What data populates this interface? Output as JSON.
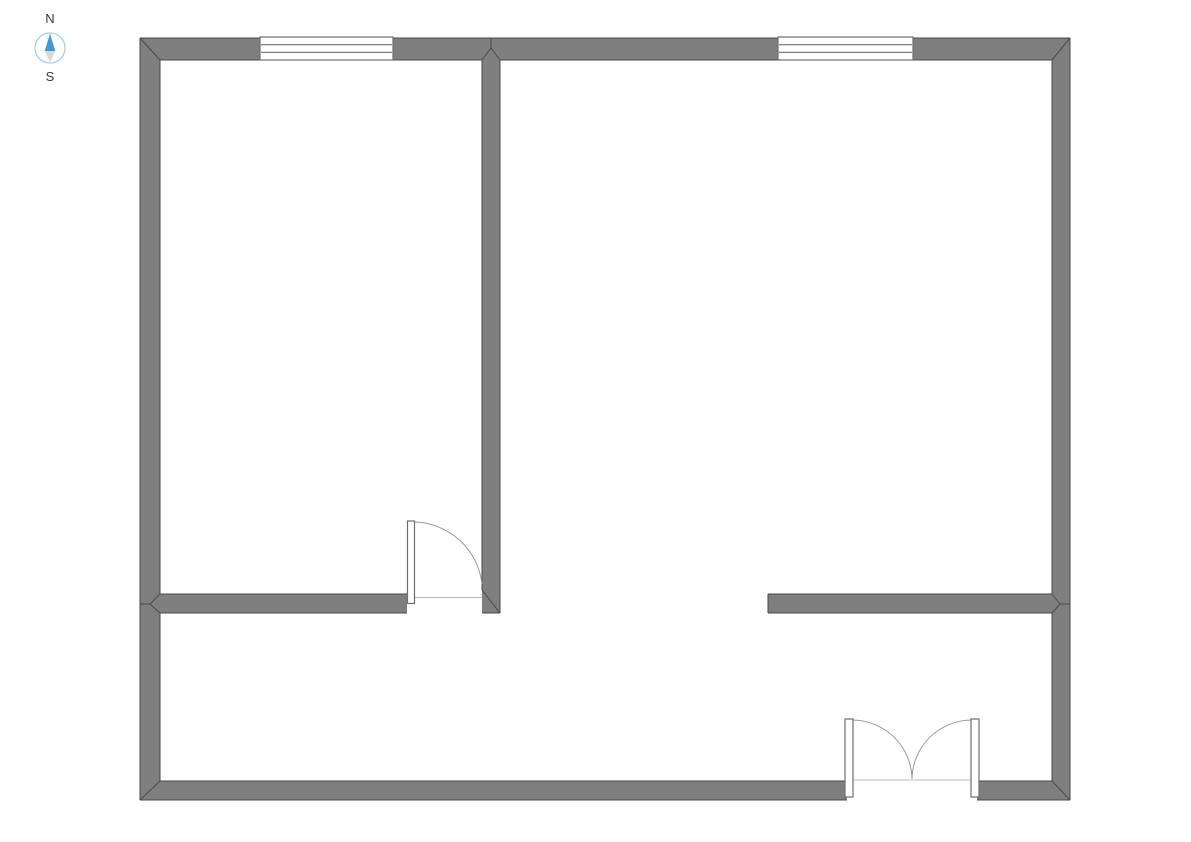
{
  "compass": {
    "north_label": "N",
    "south_label": "S"
  },
  "colors": {
    "background": "#FFFFFF",
    "wall_fill": "#7F7F7F",
    "wall_outline": "#4A4A4A",
    "opening_border": "#6E6E6E",
    "window_fill": "#FFFFFF",
    "swing_arc": "#999999",
    "threshold_line": "#BBBBBB",
    "compass_ring": "#A8CEE6",
    "compass_north": "#4697D3",
    "compass_south": "#D8D8D8",
    "compass_text": "#3A3A3A"
  },
  "floorplan": {
    "canvas": {
      "width": 1191,
      "height": 842
    },
    "walls": [
      {
        "id": "north",
        "x": 140,
        "y": 38,
        "w": 930,
        "h": 22
      },
      {
        "id": "west",
        "x": 140,
        "y": 38,
        "w": 20,
        "h": 762
      },
      {
        "id": "east",
        "x": 1052,
        "y": 38,
        "w": 18,
        "h": 762
      },
      {
        "id": "south-left",
        "x": 140,
        "y": 781,
        "w": 707,
        "h": 19
      },
      {
        "id": "south-right",
        "x": 977,
        "y": 781,
        "w": 93,
        "h": 19
      },
      {
        "id": "center-vertical",
        "x": 482,
        "y": 38,
        "w": 18,
        "h": 575
      },
      {
        "id": "middle-left",
        "x": 160,
        "y": 594,
        "w": 247,
        "h": 19
      },
      {
        "id": "middle-right",
        "x": 768,
        "y": 594,
        "w": 284,
        "h": 19
      }
    ],
    "outline_segments": [
      {
        "id": "outer-top",
        "x1": 140,
        "y1": 38,
        "x2": 1070,
        "y2": 38
      },
      {
        "id": "outer-left",
        "x1": 140,
        "y1": 38,
        "x2": 140,
        "y2": 800
      },
      {
        "id": "outer-right",
        "x1": 1070,
        "y1": 38,
        "x2": 1070,
        "y2": 800
      },
      {
        "id": "outer-bottom-a",
        "x1": 140,
        "y1": 800,
        "x2": 847,
        "y2": 800
      },
      {
        "id": "outer-bottom-b",
        "x1": 977,
        "y1": 800,
        "x2": 1070,
        "y2": 800
      },
      {
        "id": "north-inner-a",
        "x1": 160,
        "y1": 60,
        "x2": 260,
        "y2": 60
      },
      {
        "id": "north-inner-b",
        "x1": 393,
        "y1": 60,
        "x2": 482,
        "y2": 60
      },
      {
        "id": "north-inner-c",
        "x1": 500,
        "y1": 60,
        "x2": 778,
        "y2": 60
      },
      {
        "id": "north-inner-d",
        "x1": 913,
        "y1": 60,
        "x2": 1052,
        "y2": 60
      },
      {
        "id": "west-inner-a",
        "x1": 160,
        "y1": 60,
        "x2": 160,
        "y2": 594
      },
      {
        "id": "west-inner-b",
        "x1": 160,
        "y1": 613,
        "x2": 160,
        "y2": 781
      },
      {
        "id": "east-inner-a",
        "x1": 1052,
        "y1": 60,
        "x2": 1052,
        "y2": 594
      },
      {
        "id": "east-inner-b",
        "x1": 1052,
        "y1": 613,
        "x2": 1052,
        "y2": 781
      },
      {
        "id": "south-inner-a",
        "x1": 160,
        "y1": 781,
        "x2": 845,
        "y2": 781
      },
      {
        "id": "south-inner-b",
        "x1": 979,
        "y1": 781,
        "x2": 1052,
        "y2": 781
      },
      {
        "id": "center-left-face",
        "x1": 482,
        "y1": 60,
        "x2": 482,
        "y2": 590
      },
      {
        "id": "center-right-face",
        "x1": 500,
        "y1": 60,
        "x2": 500,
        "y2": 613
      },
      {
        "id": "center-bottom",
        "x1": 482,
        "y1": 613,
        "x2": 500,
        "y2": 613
      },
      {
        "id": "midleft-top",
        "x1": 160,
        "y1": 594,
        "x2": 407,
        "y2": 594
      },
      {
        "id": "midleft-bottom",
        "x1": 160,
        "y1": 613,
        "x2": 407,
        "y2": 613
      },
      {
        "id": "midright-top",
        "x1": 768,
        "y1": 594,
        "x2": 1052,
        "y2": 594
      },
      {
        "id": "midright-bottom",
        "x1": 768,
        "y1": 613,
        "x2": 1052,
        "y2": 613
      },
      {
        "id": "midright-endcap",
        "x1": 768,
        "y1": 594,
        "x2": 768,
        "y2": 613
      }
    ],
    "miter_segments": [
      {
        "id": "corner-top-left",
        "x1": 140,
        "y1": 38,
        "x2": 160,
        "y2": 60
      },
      {
        "id": "corner-top-right",
        "x1": 1070,
        "y1": 38,
        "x2": 1052,
        "y2": 60
      },
      {
        "id": "corner-bottom-left",
        "x1": 140,
        "y1": 800,
        "x2": 160,
        "y2": 781
      },
      {
        "id": "corner-bottom-right",
        "x1": 1070,
        "y1": 800,
        "x2": 1052,
        "y2": 781
      },
      {
        "id": "tee-top-a",
        "x1": 482,
        "y1": 60,
        "x2": 491,
        "y2": 48
      },
      {
        "id": "tee-top-b",
        "x1": 500,
        "y1": 60,
        "x2": 491,
        "y2": 48
      },
      {
        "id": "tee-top-c",
        "x1": 491,
        "y1": 48,
        "x2": 491,
        "y2": 38
      },
      {
        "id": "tee-west-a",
        "x1": 160,
        "y1": 594,
        "x2": 150,
        "y2": 604
      },
      {
        "id": "tee-west-b",
        "x1": 160,
        "y1": 613,
        "x2": 150,
        "y2": 604
      },
      {
        "id": "tee-west-c",
        "x1": 150,
        "y1": 604,
        "x2": 140,
        "y2": 604
      },
      {
        "id": "tee-east-a",
        "x1": 1052,
        "y1": 594,
        "x2": 1060,
        "y2": 604
      },
      {
        "id": "tee-east-b",
        "x1": 1052,
        "y1": 613,
        "x2": 1060,
        "y2": 604
      },
      {
        "id": "tee-east-c",
        "x1": 1060,
        "y1": 604,
        "x2": 1070,
        "y2": 604
      },
      {
        "id": "center-wall-end",
        "x1": 482,
        "y1": 590,
        "x2": 500,
        "y2": 613
      }
    ],
    "windows": [
      {
        "id": "north-left",
        "x": 260,
        "y": 37,
        "w": 133,
        "h": 23,
        "panes": 3
      },
      {
        "id": "north-right",
        "x": 778,
        "y": 37,
        "w": 135,
        "h": 23,
        "panes": 3
      }
    ],
    "doors": [
      {
        "id": "interior-single",
        "leaves": [
          {
            "x": 407.5,
            "y": 521,
            "w": 7,
            "h": 82.5
          }
        ],
        "arcs": [
          "M 414.5 522 A 70 70 0 0 1 482 584"
        ],
        "threshold": {
          "x1": 414.5,
          "y1": 597.5,
          "x2": 482,
          "y2": 597.5
        }
      },
      {
        "id": "entry-double",
        "leaves": [
          {
            "x": 845,
            "y": 719,
            "w": 8,
            "h": 78
          },
          {
            "x": 971,
            "y": 719,
            "w": 8,
            "h": 78
          }
        ],
        "arcs": [
          "M 853 720 A 60 60 0 0 1 912 779",
          "M 971 720 A 60 60 0 0 0 912 779"
        ],
        "threshold": {
          "x1": 853,
          "y1": 780,
          "x2": 971,
          "y2": 780
        }
      }
    ]
  }
}
